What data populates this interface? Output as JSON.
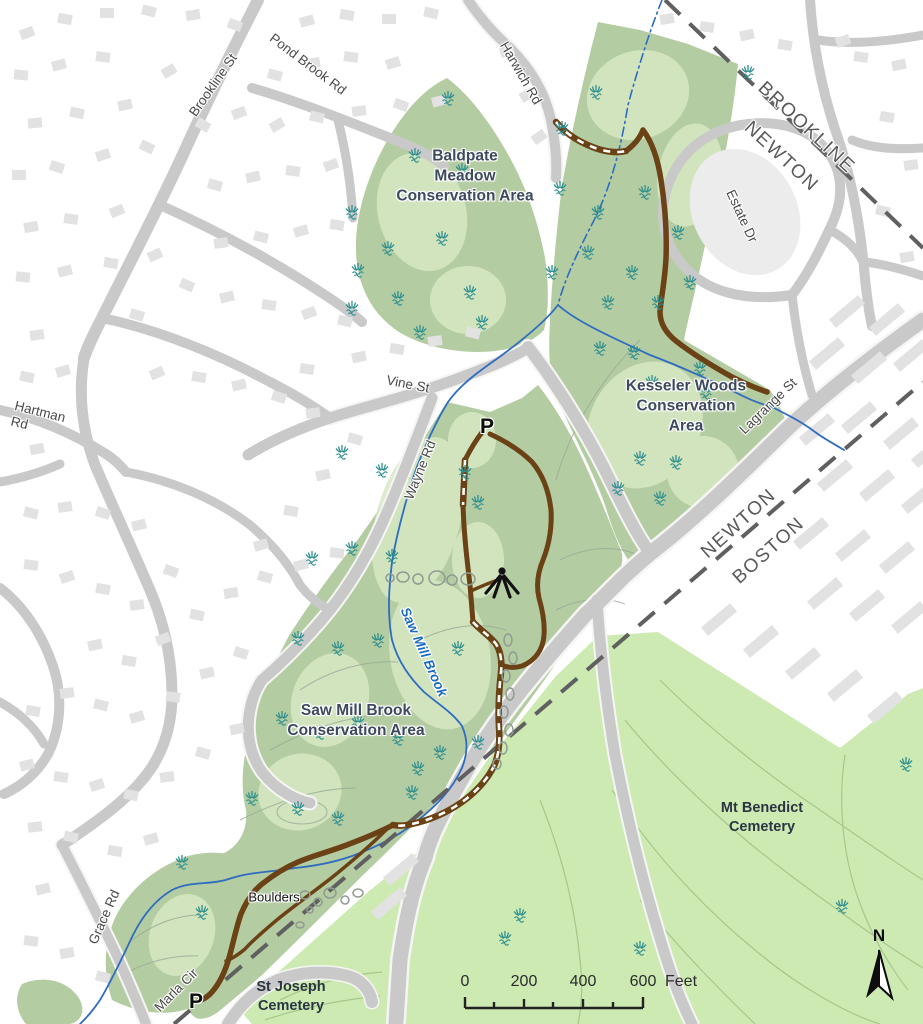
{
  "map": {
    "title": "Conservation areas trail map (Newton / Brookline / Boston)",
    "streets": {
      "brookline_st": "Brookline St",
      "pond_brook_rd": "Pond Brook Rd",
      "harwich_rd": "Harwich Rd",
      "estate_dr": "Estate Dr",
      "vine_st": "Vine St",
      "hartman_line1": "Hartman",
      "hartman_line2": "Rd",
      "wayne_rd": "Wayne Rd",
      "lagrange_st": "Lagrange St",
      "grace_rd": "Grace Rd",
      "marla_cir": "Marla Cir"
    },
    "boundaries": {
      "brookline": "BROOKLINE",
      "newton_top": "NEWTON",
      "newton_mid": "NEWTON",
      "boston": "BOSTON"
    },
    "areas": {
      "baldpate": {
        "line1": "Baldpate",
        "line2": "Meadow",
        "line3": "Conservation Area"
      },
      "kesseler": {
        "line1": "Kesseler Woods",
        "line2": "Conservation",
        "line3": "Area"
      },
      "sawmill": {
        "line1": "Saw Mill Brook",
        "line2": "Conservation Area"
      },
      "mt_benedict": {
        "line1": "Mt Benedict",
        "line2": "Cemetery"
      },
      "st_joseph": {
        "line1": "St Joseph",
        "line2": "Cemetery"
      }
    },
    "water": {
      "saw_mill_brook": "Saw Mill Brook"
    },
    "features": {
      "boulders": "Boulders"
    },
    "markers": {
      "parking": "P",
      "north": "N"
    },
    "scale": {
      "ticks": [
        "0",
        "200",
        "400",
        "600"
      ],
      "unit": "Feet"
    },
    "icons": [
      "parking-icon",
      "overlook-icon",
      "north-arrow-icon",
      "grass-marsh-icon",
      "boulder-icon"
    ],
    "colors": {
      "conservation_green": "#b4cca2",
      "light_patch_green": "#d6e9c3",
      "cemetery_green": "#cdeab3",
      "contour_olive": "#a6c78b",
      "road_gray": "#c9c9c9",
      "building_gray": "#e2e2e2",
      "stream_blue": "#2f6cc0",
      "trail_brown": "#6b4116",
      "boundary_gray": "#606060",
      "marsh_teal": "#2e8f8f",
      "label_slate": "#3d4a5e"
    }
  }
}
